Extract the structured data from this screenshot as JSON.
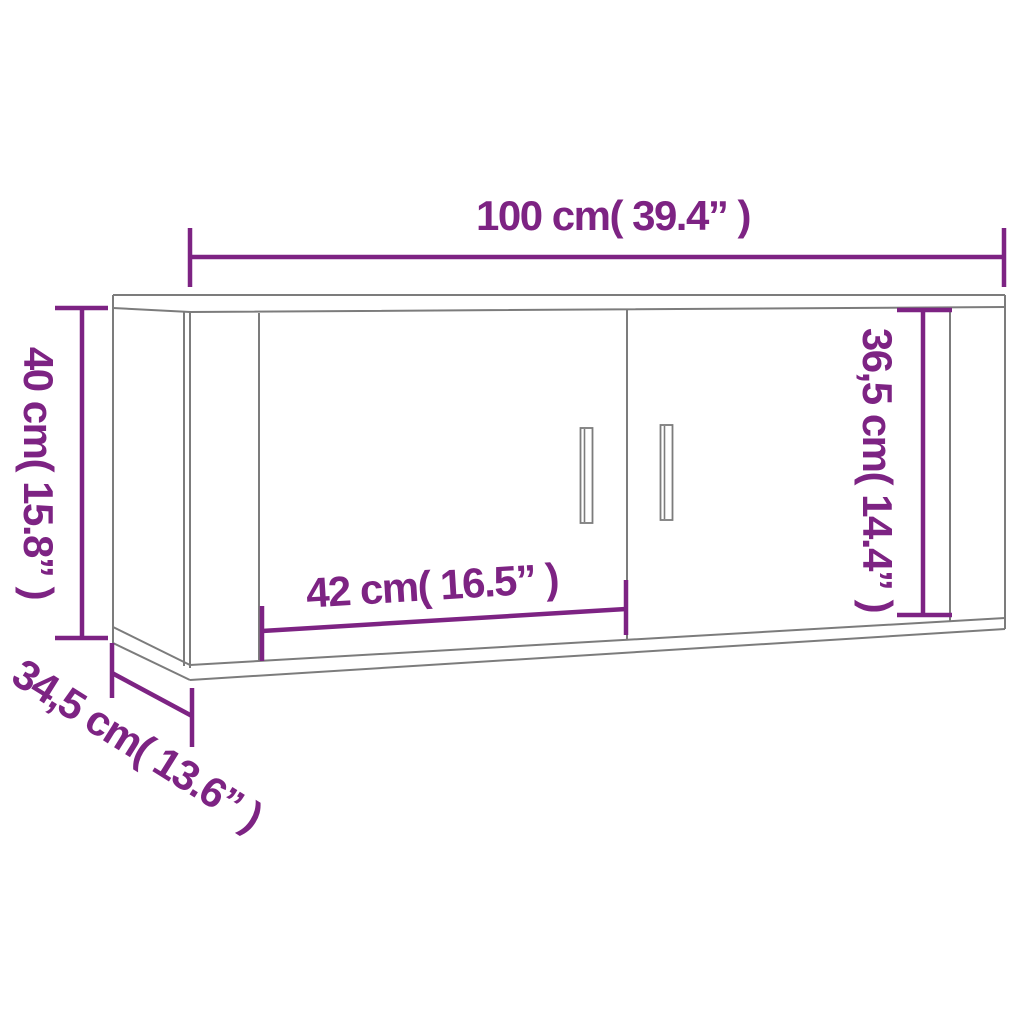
{
  "diagram": {
    "type": "furniture-dimension-drawing",
    "subject": "wall-mounted-cabinet-with-two-doors",
    "labels": {
      "width": "100 cm( 39.4” )",
      "height": "40 cm( 15.8” )",
      "depth": "34,5 cm( 13.6” )",
      "door_width": "42 cm( 16.5” )",
      "inner_height": "36,5 cm( 14.4” )"
    },
    "colors": {
      "dimension": "#7d2383",
      "outline": "#7c7c7c",
      "background": "#ffffff"
    }
  }
}
